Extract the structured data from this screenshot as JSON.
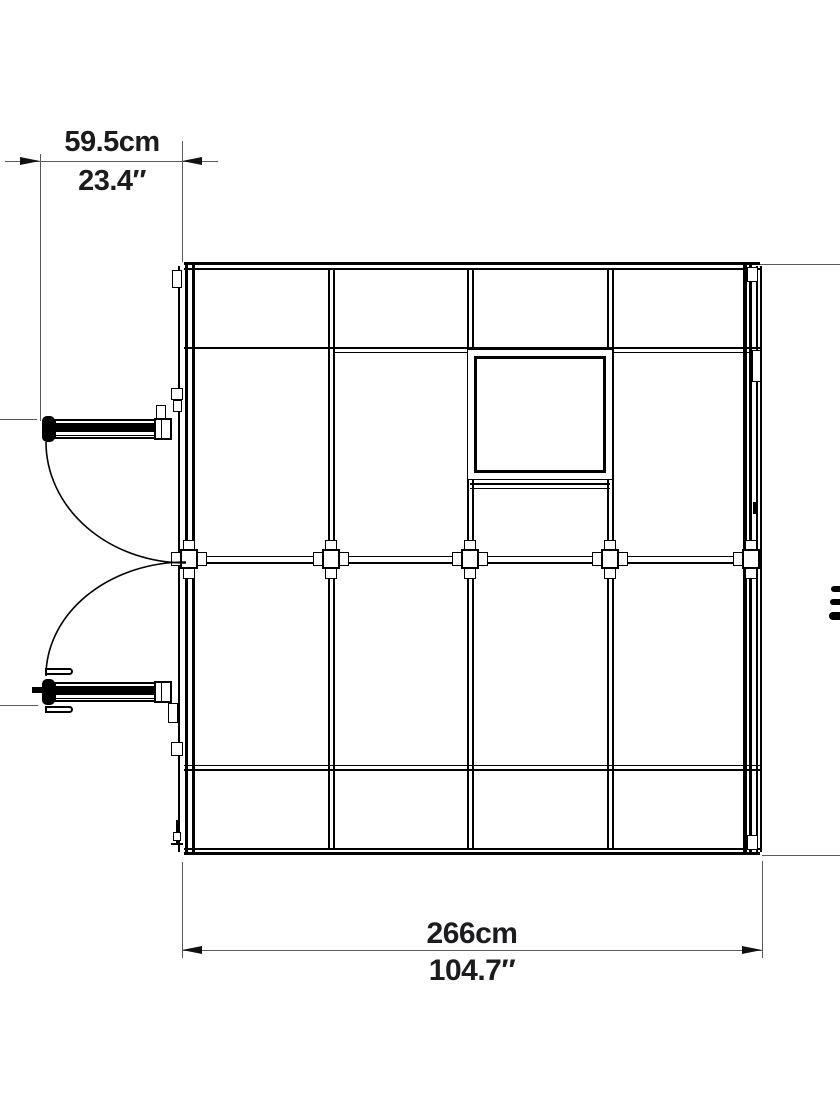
{
  "diagram": {
    "dimensions": {
      "door_width": {
        "metric": "59.5cm",
        "imperial": "23.4″"
      },
      "overall_width": {
        "metric": "266cm",
        "imperial": "104.7″"
      }
    },
    "colors": {
      "background": "#ffffff",
      "frame_line": "#000000",
      "dimension_line": "#58595b",
      "dimension_text": "#1c1c1e"
    }
  }
}
